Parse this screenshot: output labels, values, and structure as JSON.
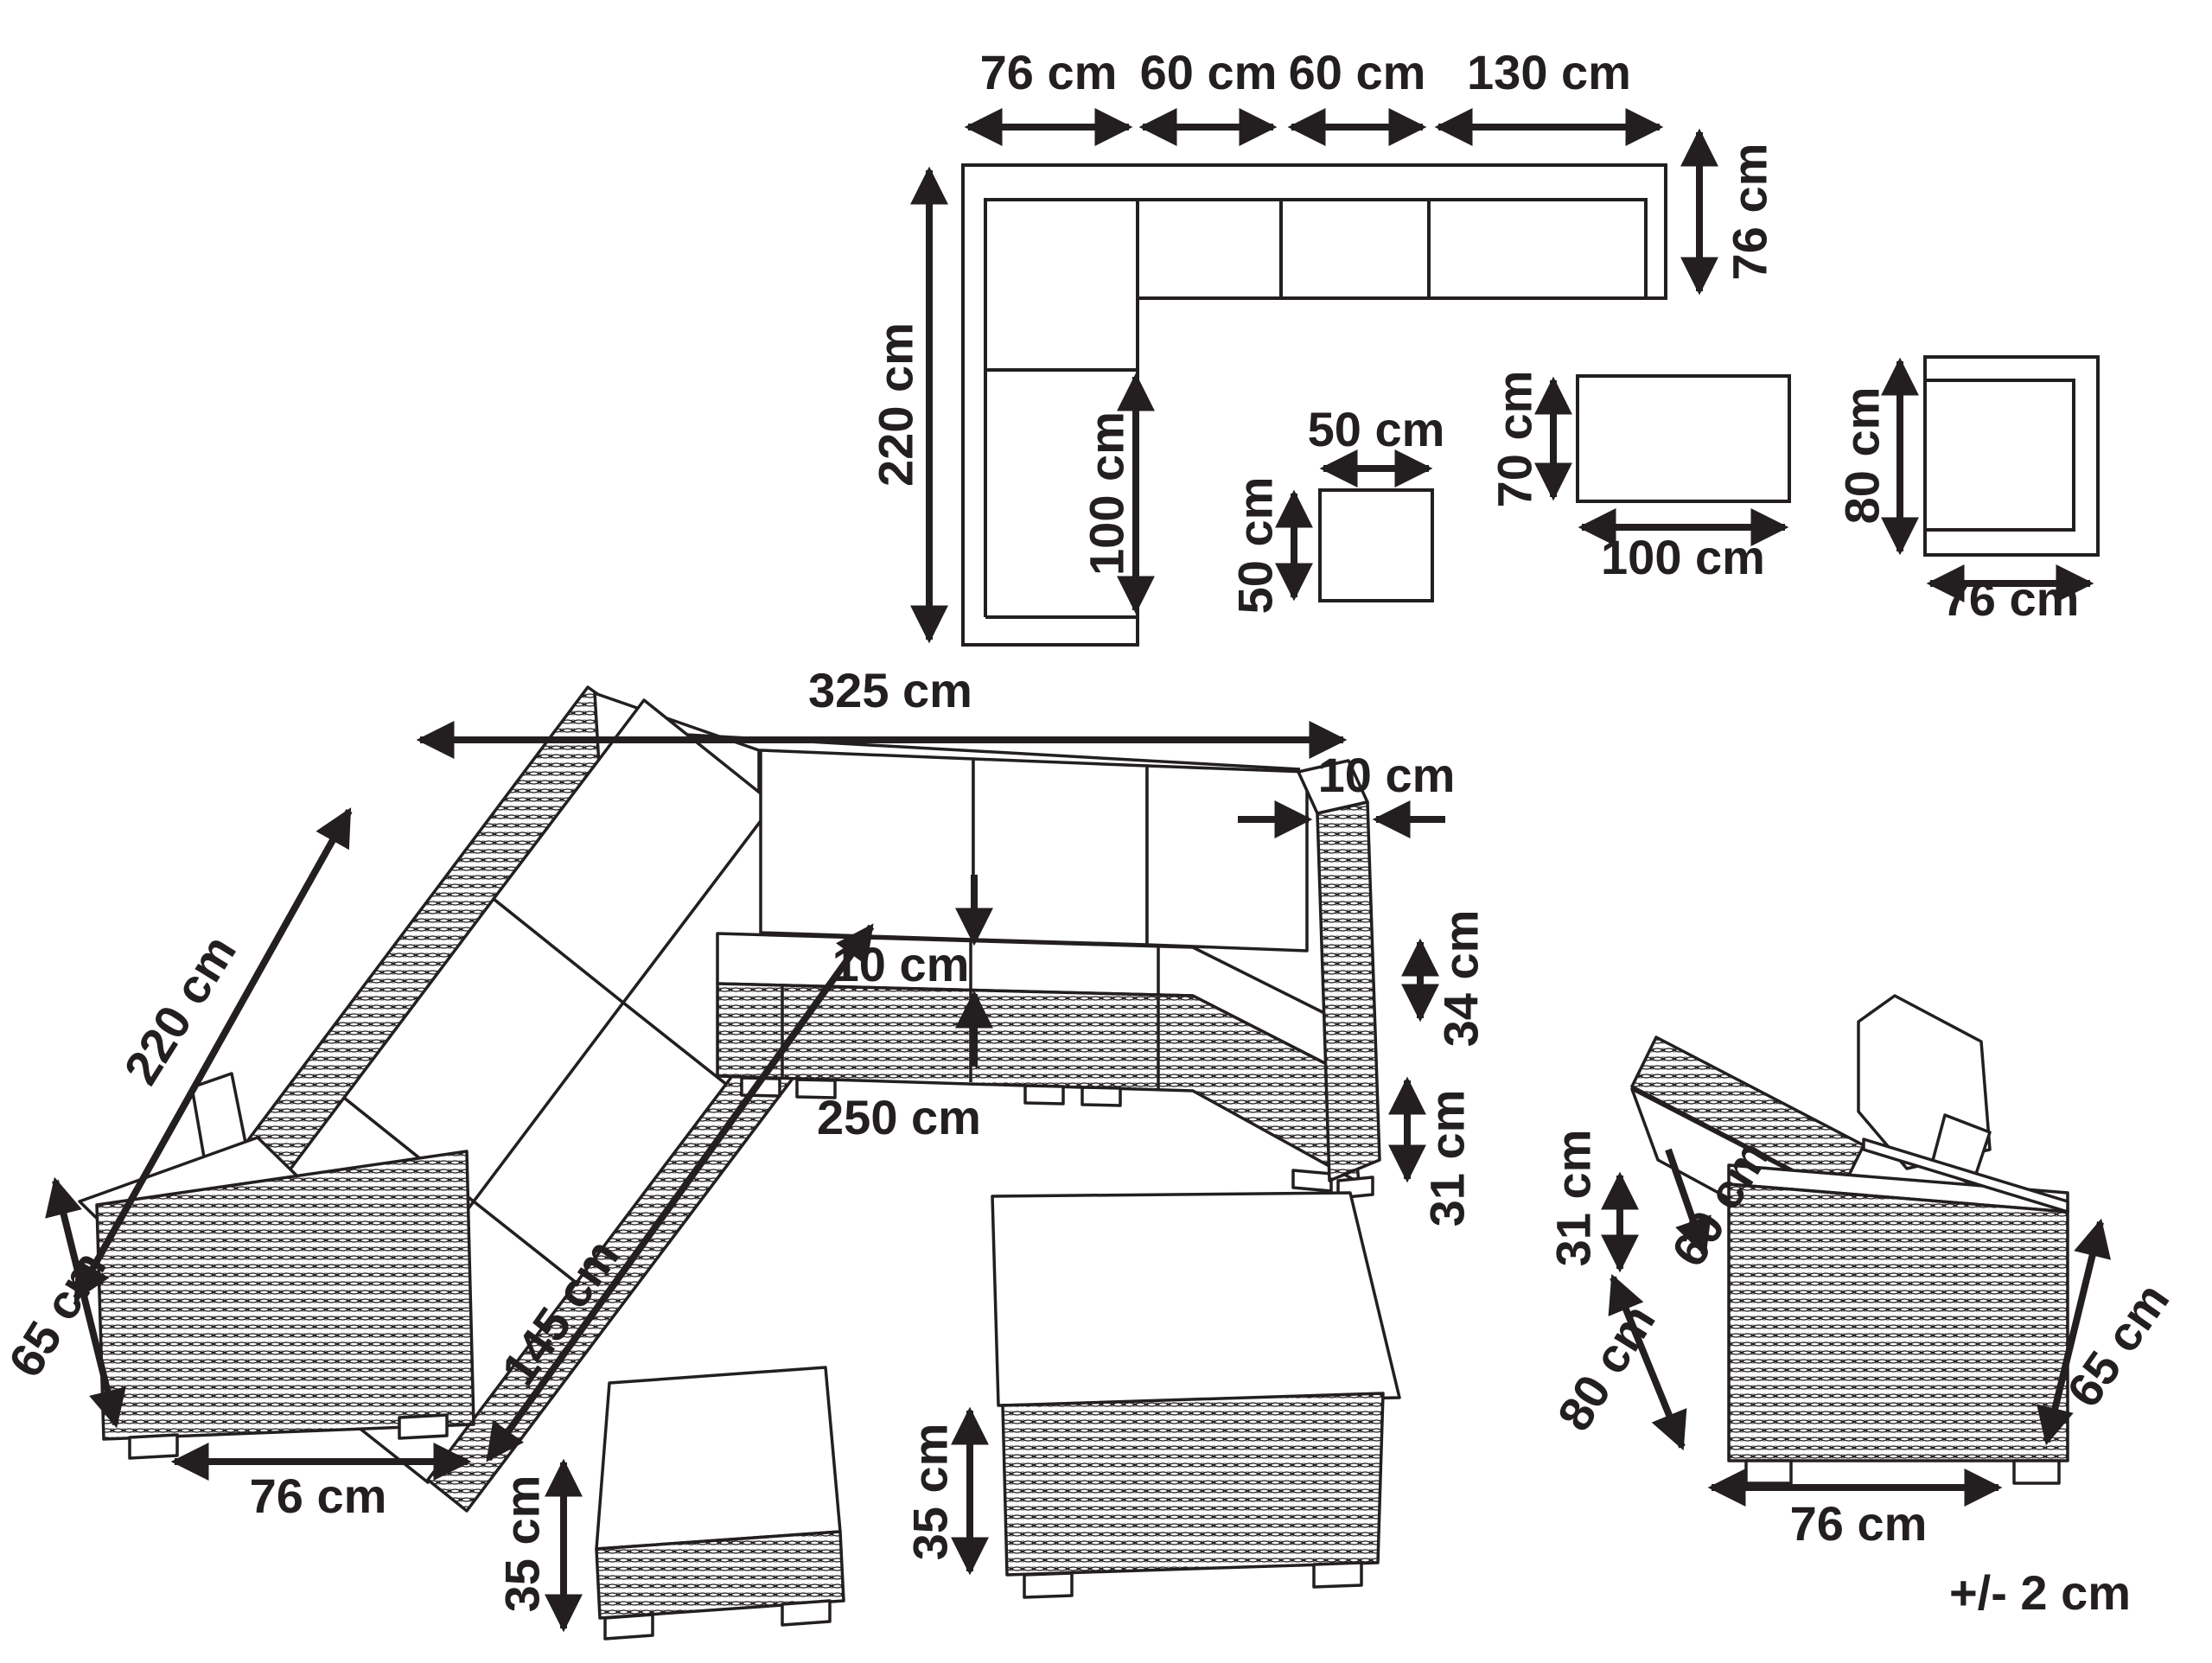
{
  "colors": {
    "ink": "#231f20",
    "background": "#ffffff"
  },
  "tolerance": "+/- 2 cm",
  "top_view": {
    "sofa": {
      "segment_widths": [
        "76 cm",
        "60 cm",
        "60 cm",
        "130 cm"
      ],
      "total_depth_left": "220 cm",
      "arm_depth_right": "76 cm",
      "chaise_length": "100 cm"
    },
    "side_table": {
      "width": "50 cm",
      "depth": "50 cm"
    },
    "coffee_table": {
      "depth": "70 cm",
      "width": "100 cm"
    },
    "armchair": {
      "depth": "80 cm",
      "width": "76 cm"
    }
  },
  "front_view": {
    "sofa": {
      "total_width": "325 cm",
      "armrest_thickness": "10 cm",
      "left_side_length": "220 cm",
      "backrest_above_seat": "34 cm",
      "base_height": "31 cm",
      "cushion_thickness": "10 cm",
      "seat_row_width": "250 cm",
      "left_side_inner_length": "145 cm",
      "armrest_height": "65 cm",
      "armrest_width": "76 cm"
    },
    "ottoman": {
      "height": "35 cm"
    },
    "coffee_table": {
      "height": "35 cm"
    },
    "armchair": {
      "armrest_above_seat": "31 cm",
      "seat_depth": "60 cm",
      "total_depth": "80 cm",
      "total_height": "65 cm",
      "width": "76 cm"
    }
  }
}
